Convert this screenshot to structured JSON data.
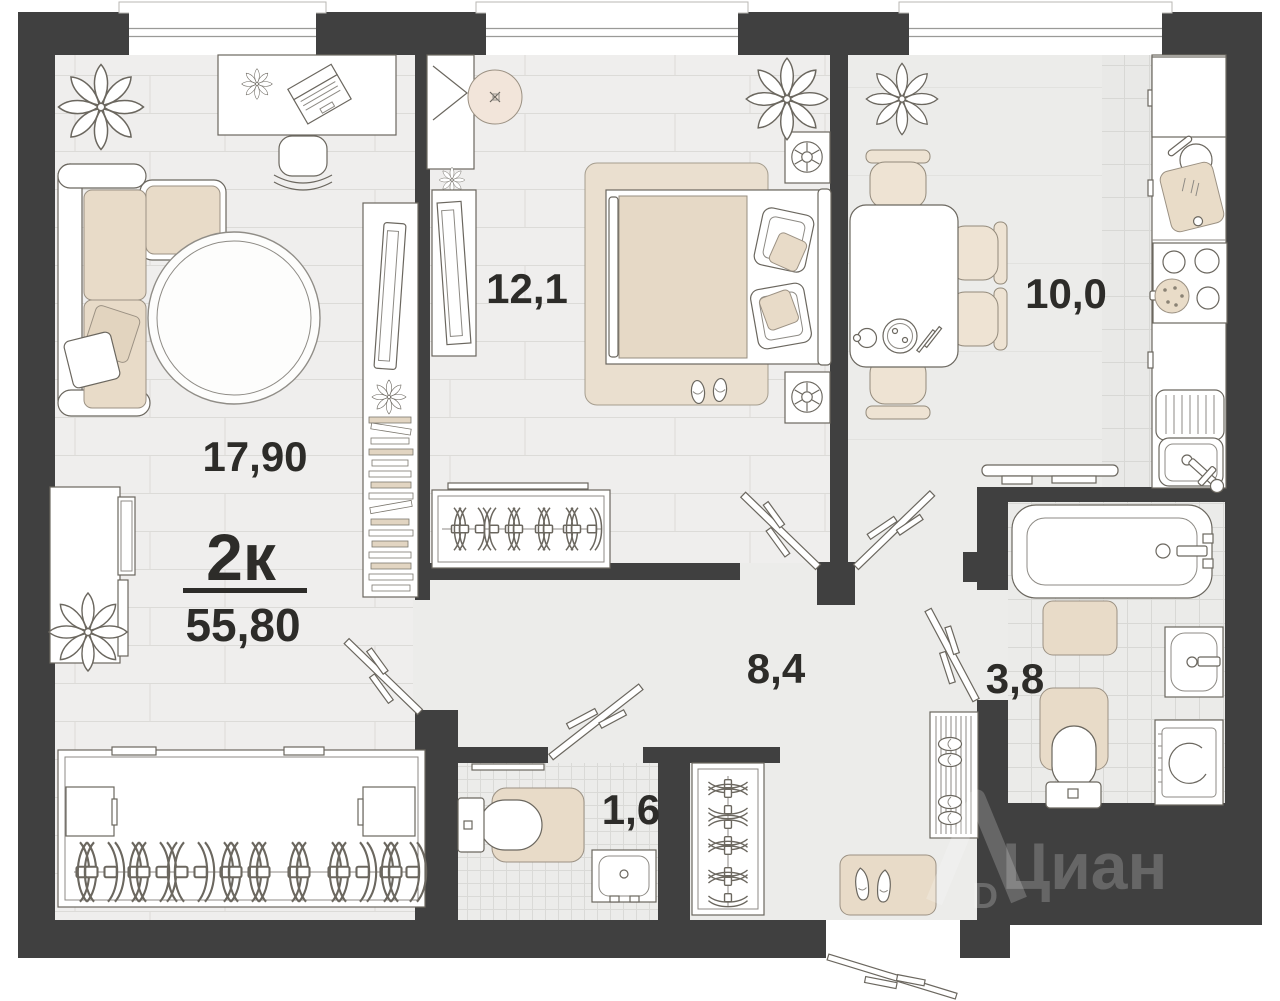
{
  "plan": {
    "type_label": "2к",
    "total_area_label": "55,80",
    "rooms": {
      "living": "17,90",
      "bedroom": "12,1",
      "kitchen": "10,0",
      "hallway": "8,4",
      "bathroom": "3,8",
      "wc": "1,6"
    },
    "watermark": {
      "brand": "Циан",
      "letter": "D"
    },
    "colors": {
      "wall": "#404040",
      "accent_beige": "#e8dbc8",
      "floor": "#ececea"
    }
  }
}
